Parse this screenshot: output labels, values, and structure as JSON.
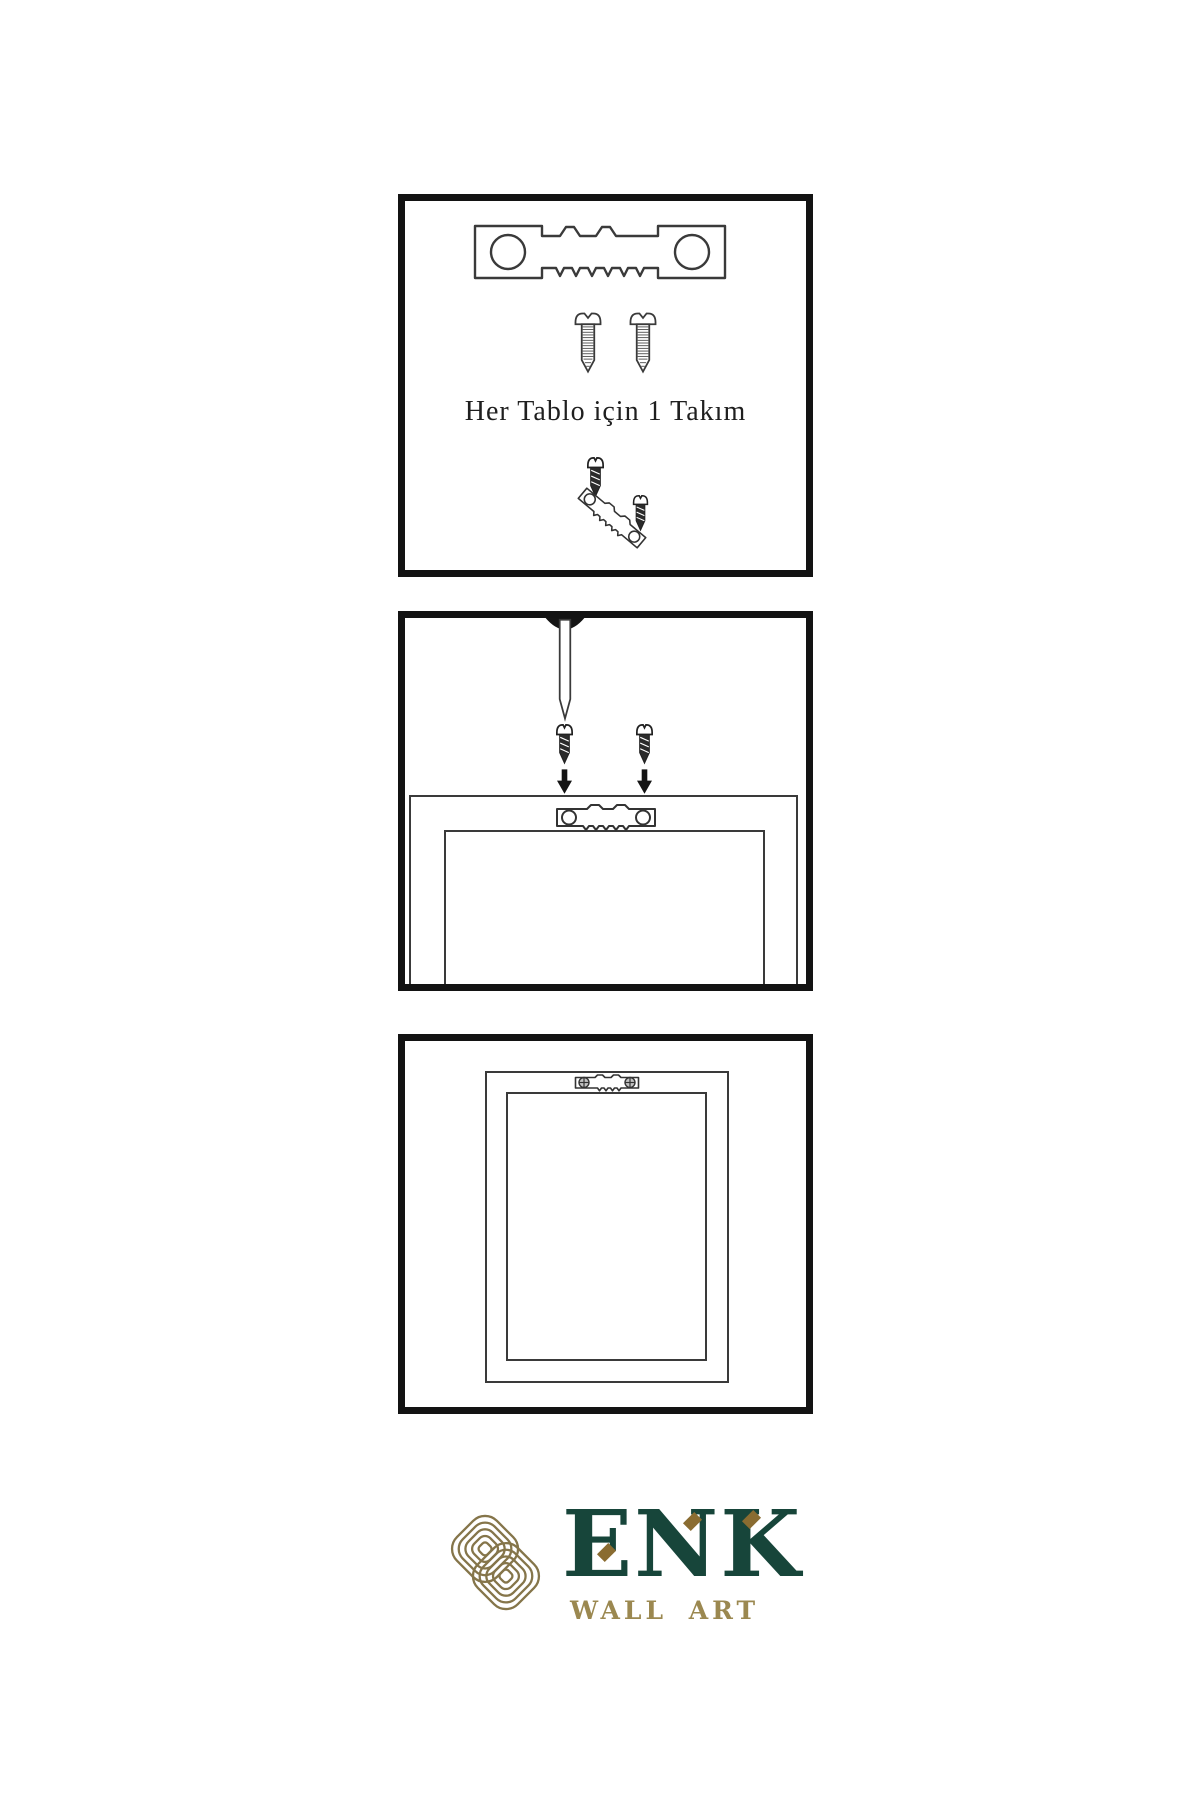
{
  "page": {
    "background_color": "#ffffff"
  },
  "colors": {
    "panel_border": "#131313",
    "line_art": "#3a3a3a",
    "hardware_dark": "#2b2b2b",
    "brand_green": "#17453a",
    "brand_gold": "#9b8850",
    "emblem_gold": "#85754a",
    "accent_diamond": "#8a6c31"
  },
  "panels": [
    {
      "name": "hardware-kit",
      "caption": "Her Tablo için 1 Takım",
      "items": [
        "sawtooth-hanger",
        "screw",
        "screw",
        "screw-driven-into-tilted-hanger"
      ]
    },
    {
      "name": "wall-mounting",
      "items": [
        "wall-nail",
        "screw-with-down-arrow",
        "screw-with-down-arrow",
        "sawtooth-hanger-on-frame-back"
      ]
    },
    {
      "name": "hung-frame",
      "items": [
        "frame-back",
        "installed-sawtooth-hanger-with-screws"
      ]
    }
  ],
  "logo": {
    "brand": "ENK",
    "subtitle": "WALL ART"
  }
}
